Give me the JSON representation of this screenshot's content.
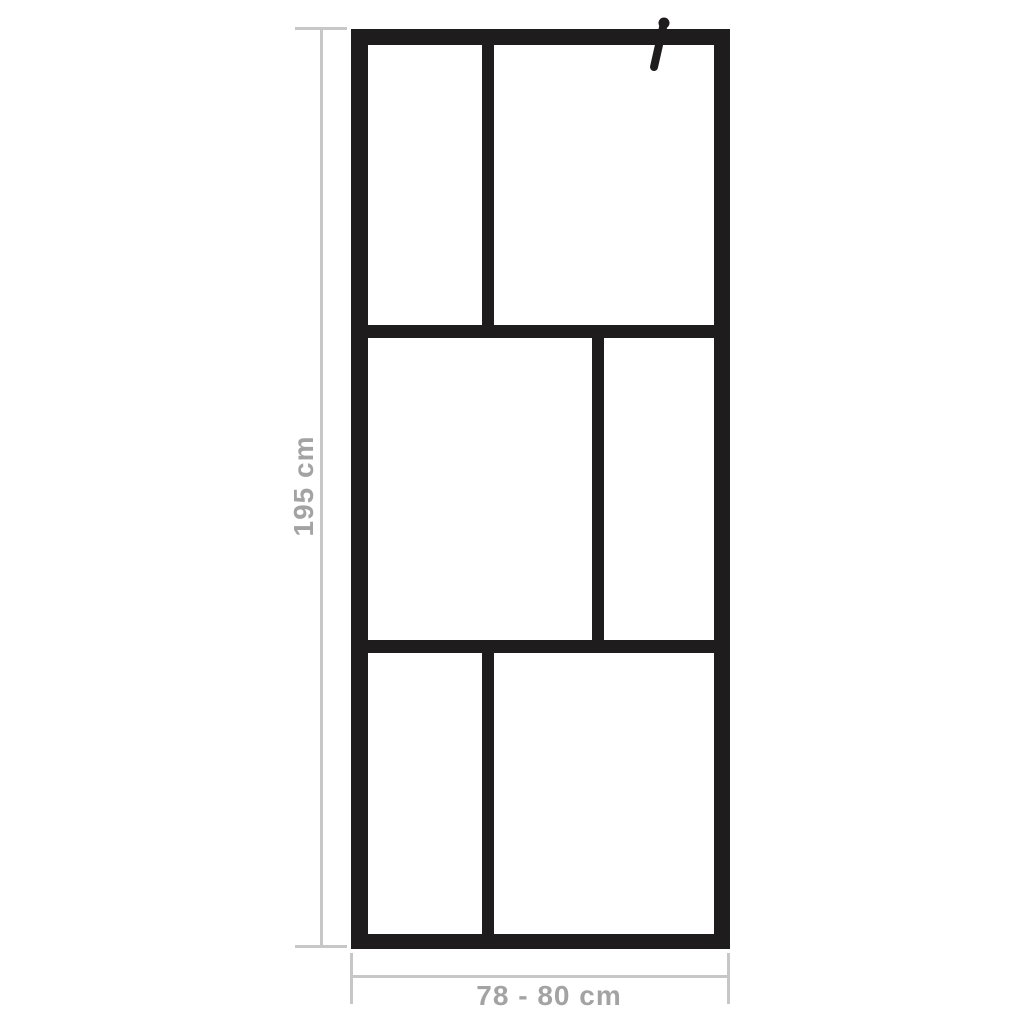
{
  "diagram": {
    "kind": "product-dimension-diagram",
    "frame_grid": {
      "rows": 3,
      "panels_per_row": 2,
      "total_panels": 6
    }
  },
  "dimensions": {
    "height_label": "195 cm",
    "width_label": "78 - 80 cm"
  },
  "icons": {
    "support_bar": "diagonal-support-bar"
  },
  "colors": {
    "frame": "#1e1c1c",
    "dim_line": "#c7c7c7",
    "dim_text": "#a3a3a3",
    "background": "#ffffff"
  }
}
